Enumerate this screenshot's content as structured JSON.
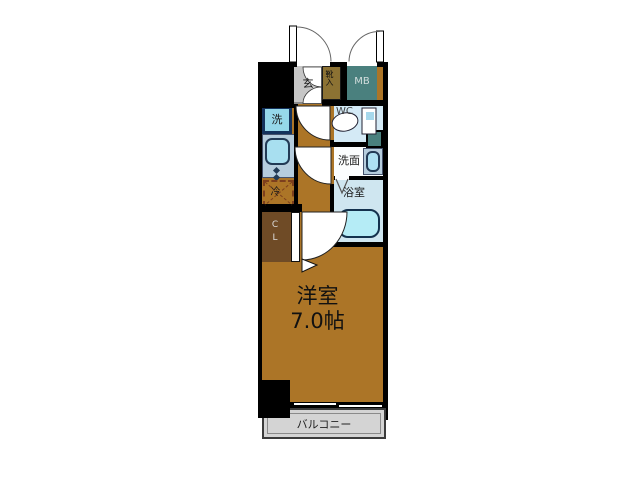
{
  "rooms": {
    "entrance": {
      "label": "玄"
    },
    "shoe_cabinet": {
      "label": "靴入"
    },
    "meter_box": {
      "label": "MB"
    },
    "toilet": {
      "label": "WC"
    },
    "washer": {
      "label": "洗"
    },
    "refrigerator": {
      "label": "冷"
    },
    "washroom": {
      "label": "洗面"
    },
    "bathroom": {
      "label": "浴室"
    },
    "closet": {
      "label": "CL"
    },
    "main_room": {
      "name": "洋室",
      "size": "7.0帖"
    },
    "balcony": {
      "label": "バルコニー"
    }
  },
  "colors": {
    "wall": "#000000",
    "wood_floor": "#ac7527",
    "entrance_floor": "#c6c6c6",
    "shoe_cabinet": "#8c7233",
    "meter_box": "#4a807e",
    "wc_floor": "#d4eaf6",
    "washroom_floor": "#fbfdfe",
    "bathroom_floor": "#cfe6f0",
    "fixture_cyan": "#a8dff0",
    "closet_brown": "#6f4b26",
    "balcony_gray": "#d4d4d4"
  }
}
